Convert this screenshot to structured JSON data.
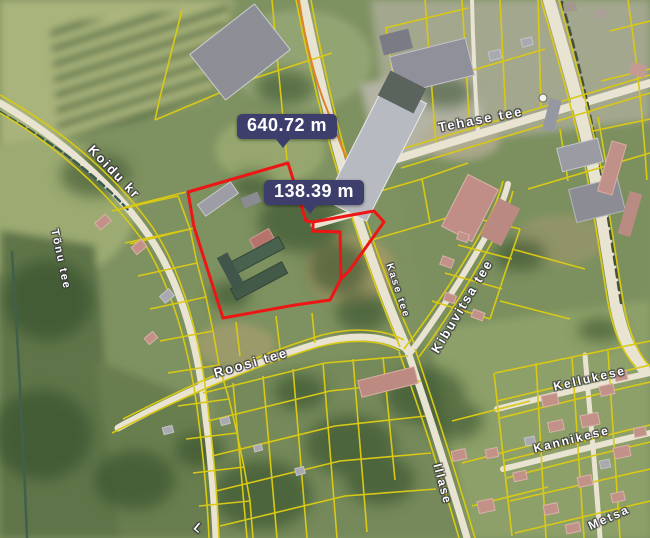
{
  "map": {
    "measurement_labels": {
      "perimeter": "640.72 m",
      "segment": "138.39 m"
    },
    "street_labels": {
      "koidu": "Koidu kr",
      "tonu": "Tõnu tee",
      "tehase": "Tehase tee",
      "kase": "Kase tee",
      "kibuvitsa": "Kibuvitsa tee",
      "roosi": "Roosi tee",
      "kellukese": "Kellukese",
      "kannikese": "Kannikese",
      "illase": "Illase",
      "metsa": "Metsa",
      "edge_partial": "L"
    },
    "colors": {
      "parcel_highlight": "#ee1515",
      "cadastral_line": "#d9c915",
      "road_fill": "#e9e3d1",
      "measurement_badge_bg": "#3e3e6c",
      "measurement_badge_text": "#ffffff",
      "stream": "#3c5a50",
      "orange_boundary": "#e08226"
    }
  }
}
